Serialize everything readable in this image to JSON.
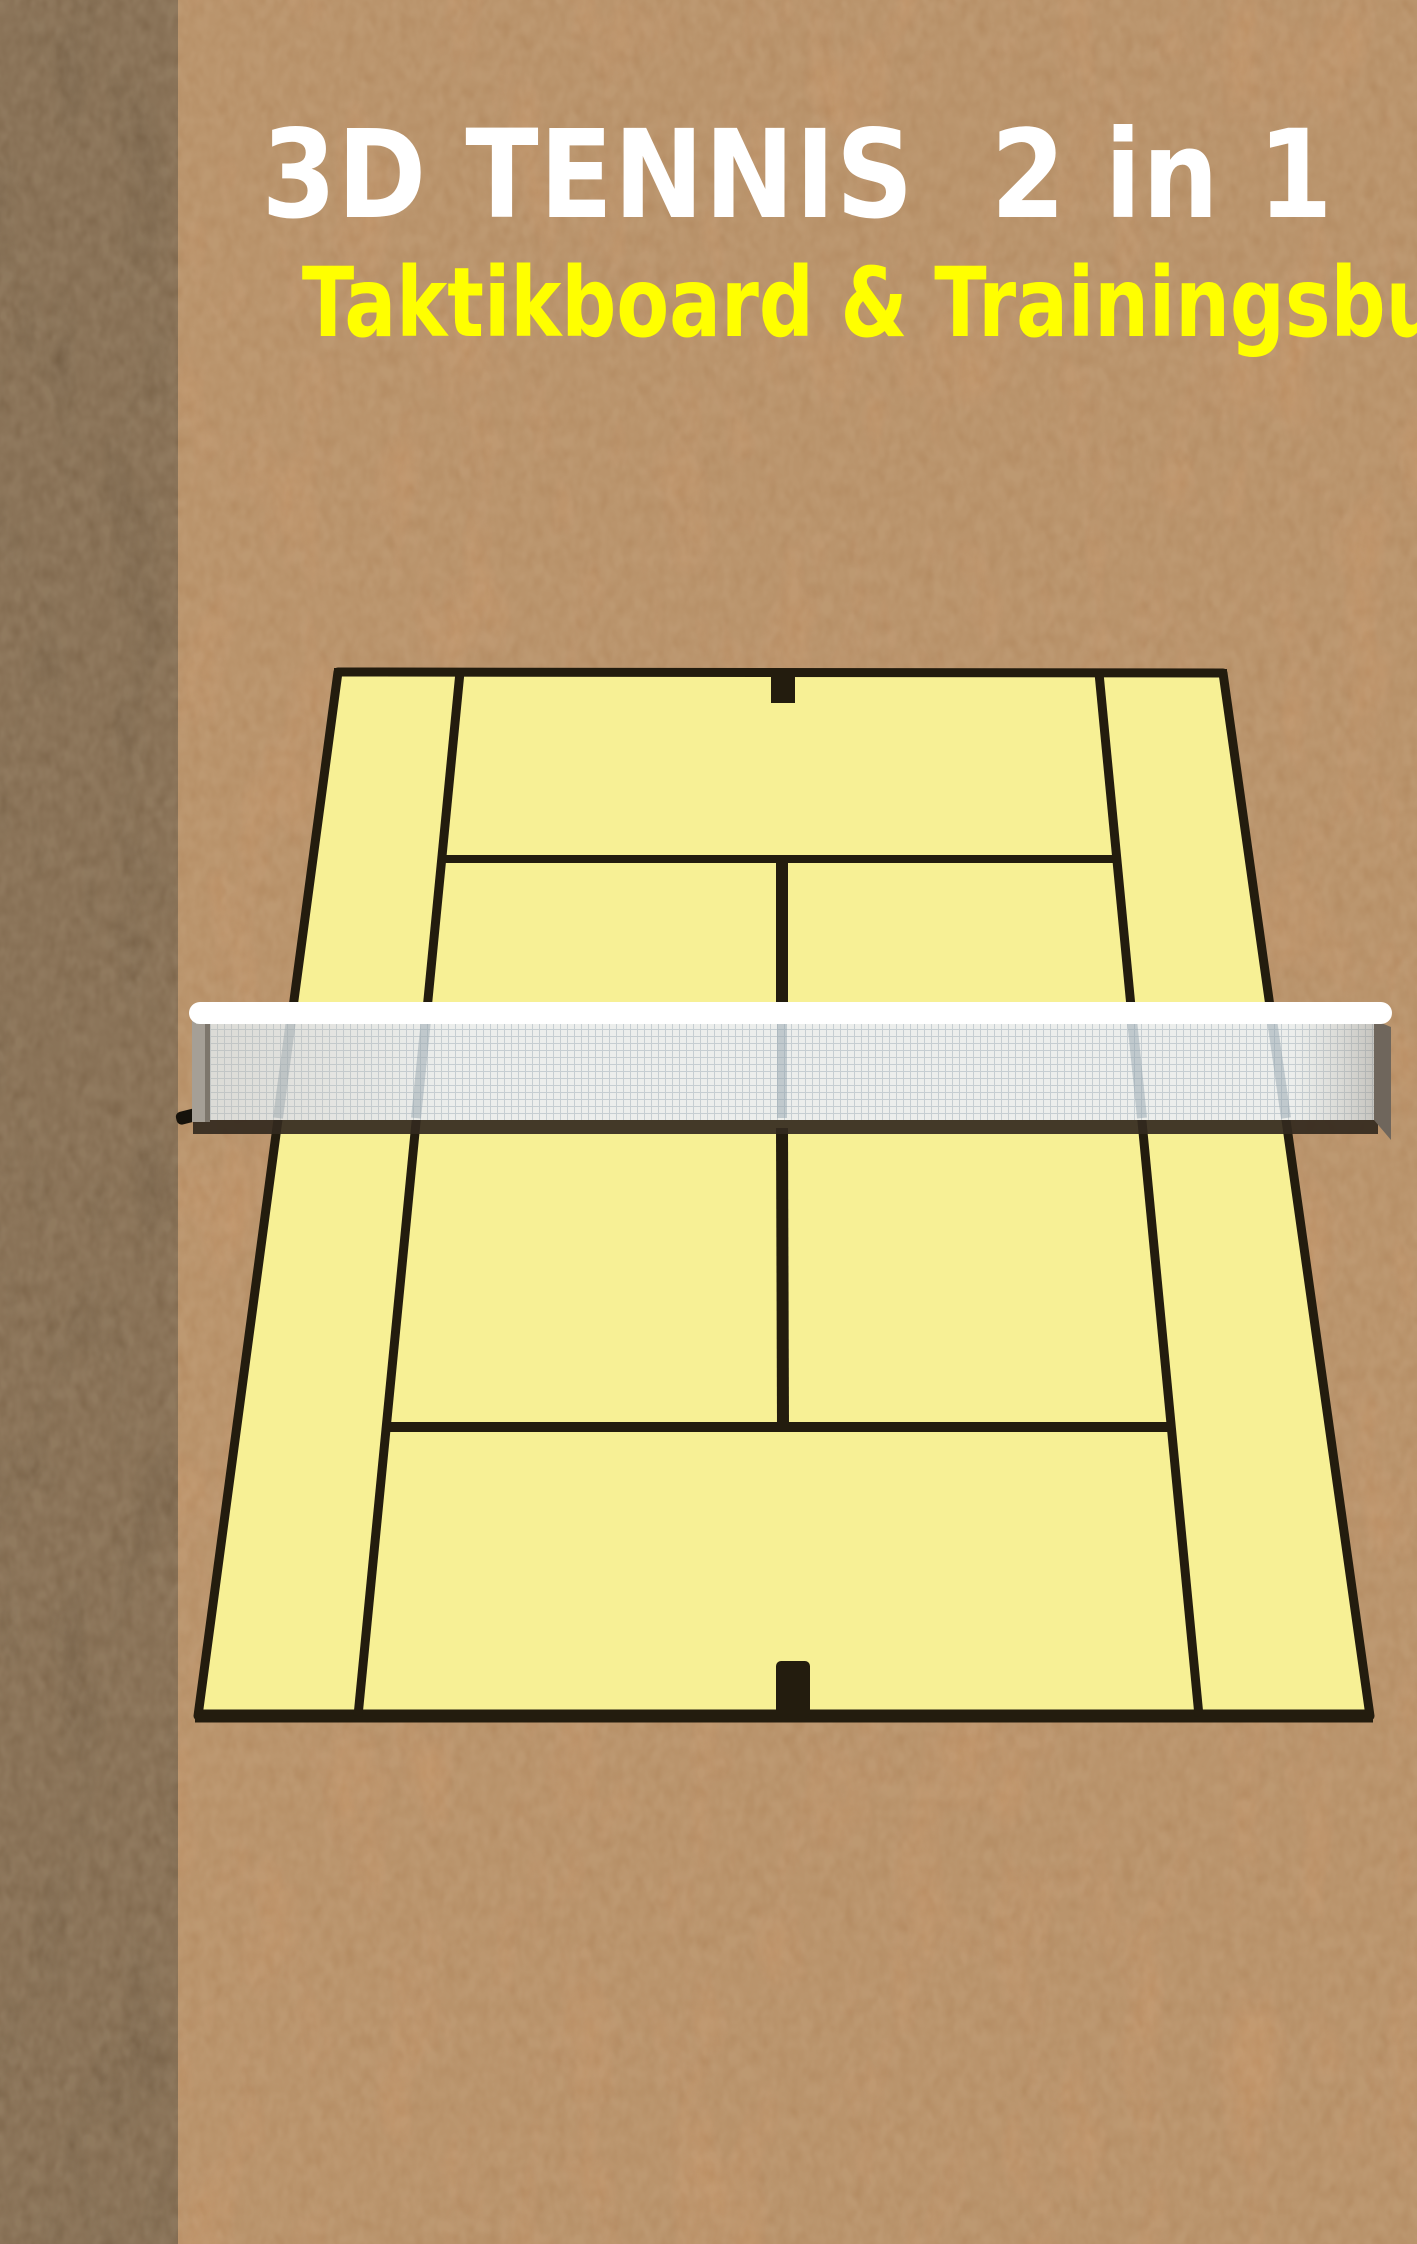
{
  "cover": {
    "title": "3D TENNIS  2 in 1",
    "subtitle": "Taktikboard & Trainingsbuch",
    "title_color": "#ffffff",
    "subtitle_color": "#ffff00"
  },
  "illustration": {
    "name": "3d-perspective-tennis-court-with-net",
    "background_color": "#c28c5b",
    "spine_color": "#5d4831",
    "court_color": "#f7f095",
    "line_color": "#231c0e",
    "net_band_color": "#ffffff",
    "net_mesh_color": "#eceeec",
    "net_grid_color": "#c6ced2",
    "net_shadow_color": "#33291e"
  }
}
